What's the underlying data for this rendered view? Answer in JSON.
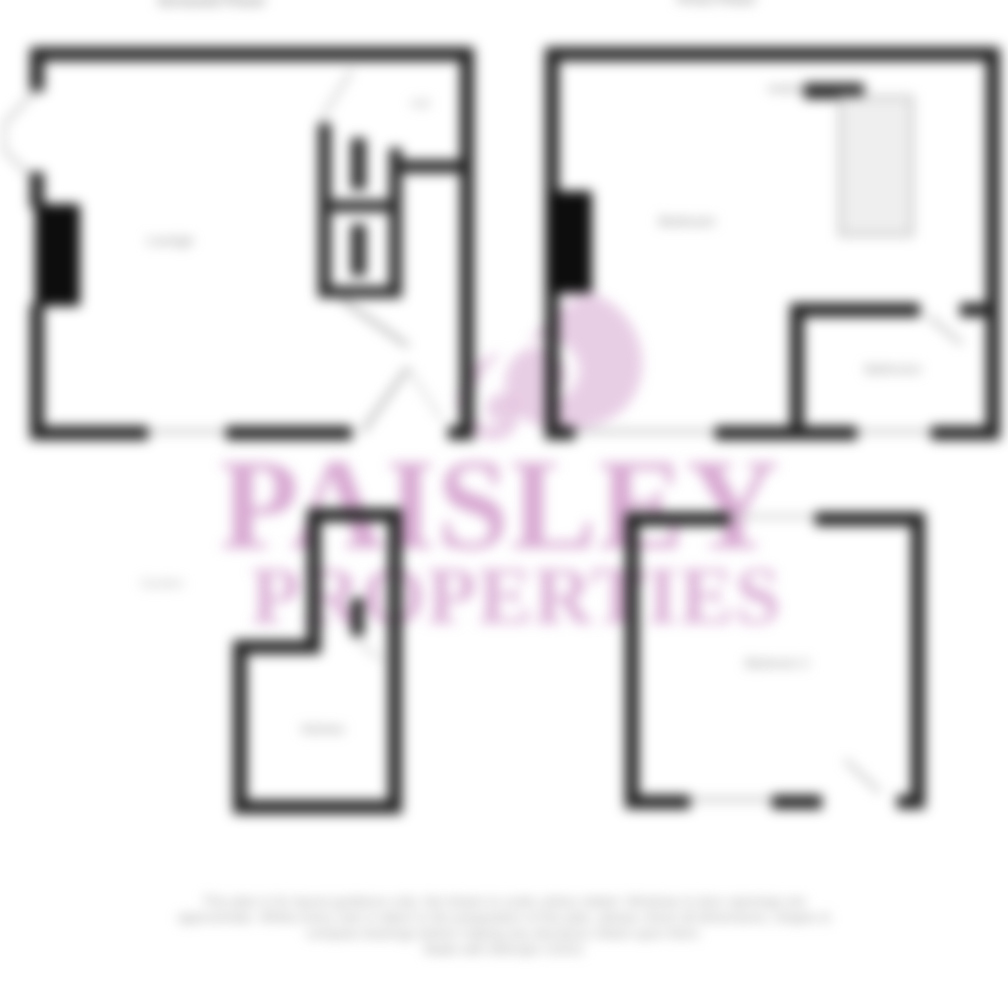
{
  "watermark": {
    "name": "PAISLEY",
    "tagline": "PROPERTIES",
    "logo_icon": "paisley-drop-icon"
  },
  "floors": {
    "ground": {
      "title": "Ground Floor",
      "rooms": {
        "lounge": "Lounge",
        "hall": "Hall",
        "kitchen": "Kitchen"
      },
      "outside_label": "Garden"
    },
    "first": {
      "title": "First Floor",
      "rooms": {
        "bedroom": "Bedroom",
        "bathroom": "Bathroom",
        "bedroom2": "Bedroom 2"
      }
    }
  },
  "disclaimer": {
    "lines": [
      "This plan is for layout guidance only. Not drawn to scale unless stated. Windows & door openings are",
      "approximate. Whilst every care is taken in the preparation of this plan, please check all dimensions, shapes &",
      "compass bearings before making any decisions reliant upon them.",
      "Made with Metropix ©2021"
    ]
  },
  "colors": {
    "wall": "#232323",
    "solid_block": "#0d0d0d",
    "thin_line": "#a8a8a8",
    "watermark_pink": "#ce94c7",
    "logo_pink": "#d8a9d1",
    "label_gray": "#8a8a8a",
    "disclaimer_gray": "#9b9b9b"
  }
}
